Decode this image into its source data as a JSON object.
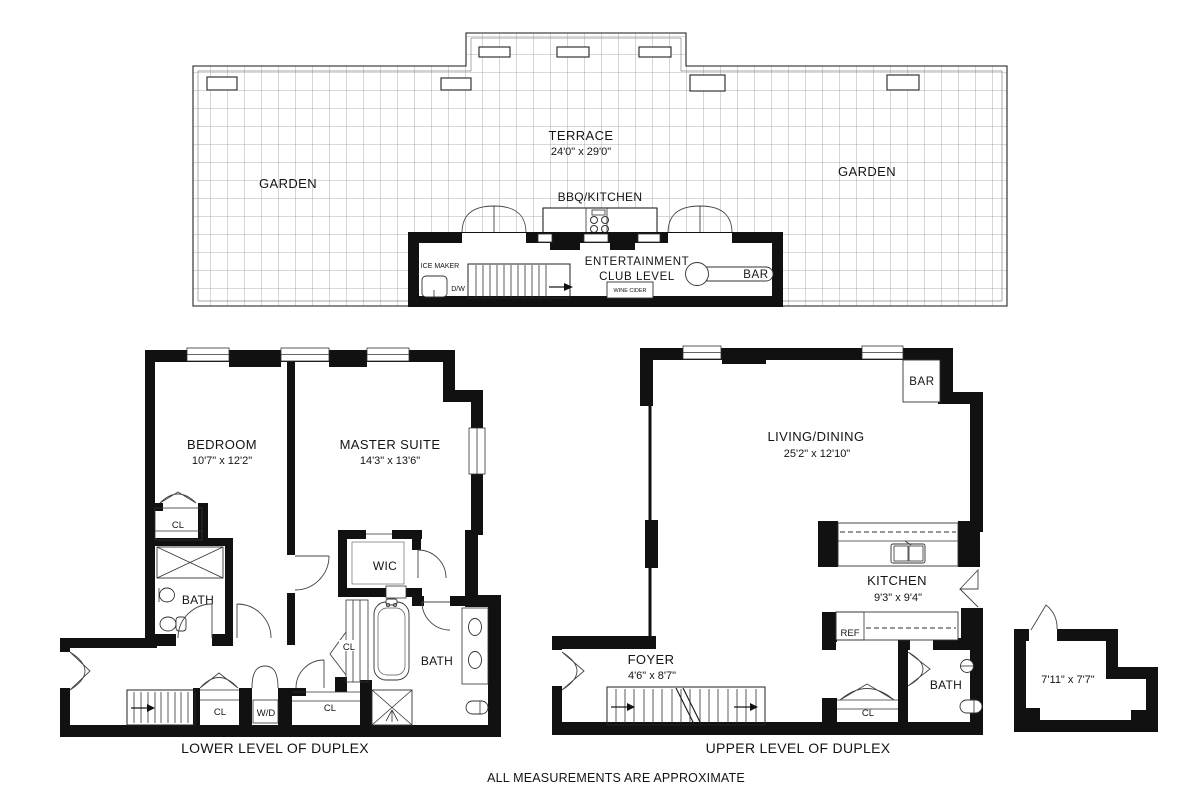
{
  "club_level": {
    "terrace_name": "TERRACE",
    "terrace_dims": "24'0\" x 29'0\"",
    "garden_left": "GARDEN",
    "garden_right": "GARDEN",
    "bbq_kitchen": "BBQ/KITCHEN",
    "entertainment_line1": "ENTERTAINMENT",
    "entertainment_line2": "CLUB LEVEL",
    "ice_maker": "ICE MAKER",
    "dishwasher": "D/W",
    "wine_cider": "WINE CIDER",
    "bar": "BAR"
  },
  "lower_level": {
    "caption": "LOWER LEVEL OF DUPLEX",
    "bedroom_name": "BEDROOM",
    "bedroom_dims": "10'7\" x 12'2\"",
    "master_name": "MASTER SUITE",
    "master_dims": "14'3\" x 13'6\"",
    "closet_bedroom": "CL",
    "bath_bedroom": "BATH",
    "wic": "WIC",
    "closet_linen": "CL",
    "bath_master": "BATH",
    "closet_hall_1": "CL",
    "washer_dryer": "W/D",
    "closet_hall_2": "CL"
  },
  "upper_level": {
    "caption": "UPPER LEVEL OF DUPLEX",
    "living_name": "LIVING/DINING",
    "living_dims": "25'2\" x 12'10\"",
    "bar": "BAR",
    "kitchen_name": "KITCHEN",
    "kitchen_dims": "9'3\" x 9'4\"",
    "ref": "REF",
    "foyer_name": "FOYER",
    "foyer_dims": "4'6\" x 8'7\"",
    "bath": "BATH",
    "closet": "CL",
    "storage_dims": "7'11\" x 7'7\""
  },
  "footer": {
    "note": "ALL MEASUREMENTS ARE APPROXIMATE"
  },
  "colors": {
    "ink": "#111111",
    "grid": "#999999"
  }
}
